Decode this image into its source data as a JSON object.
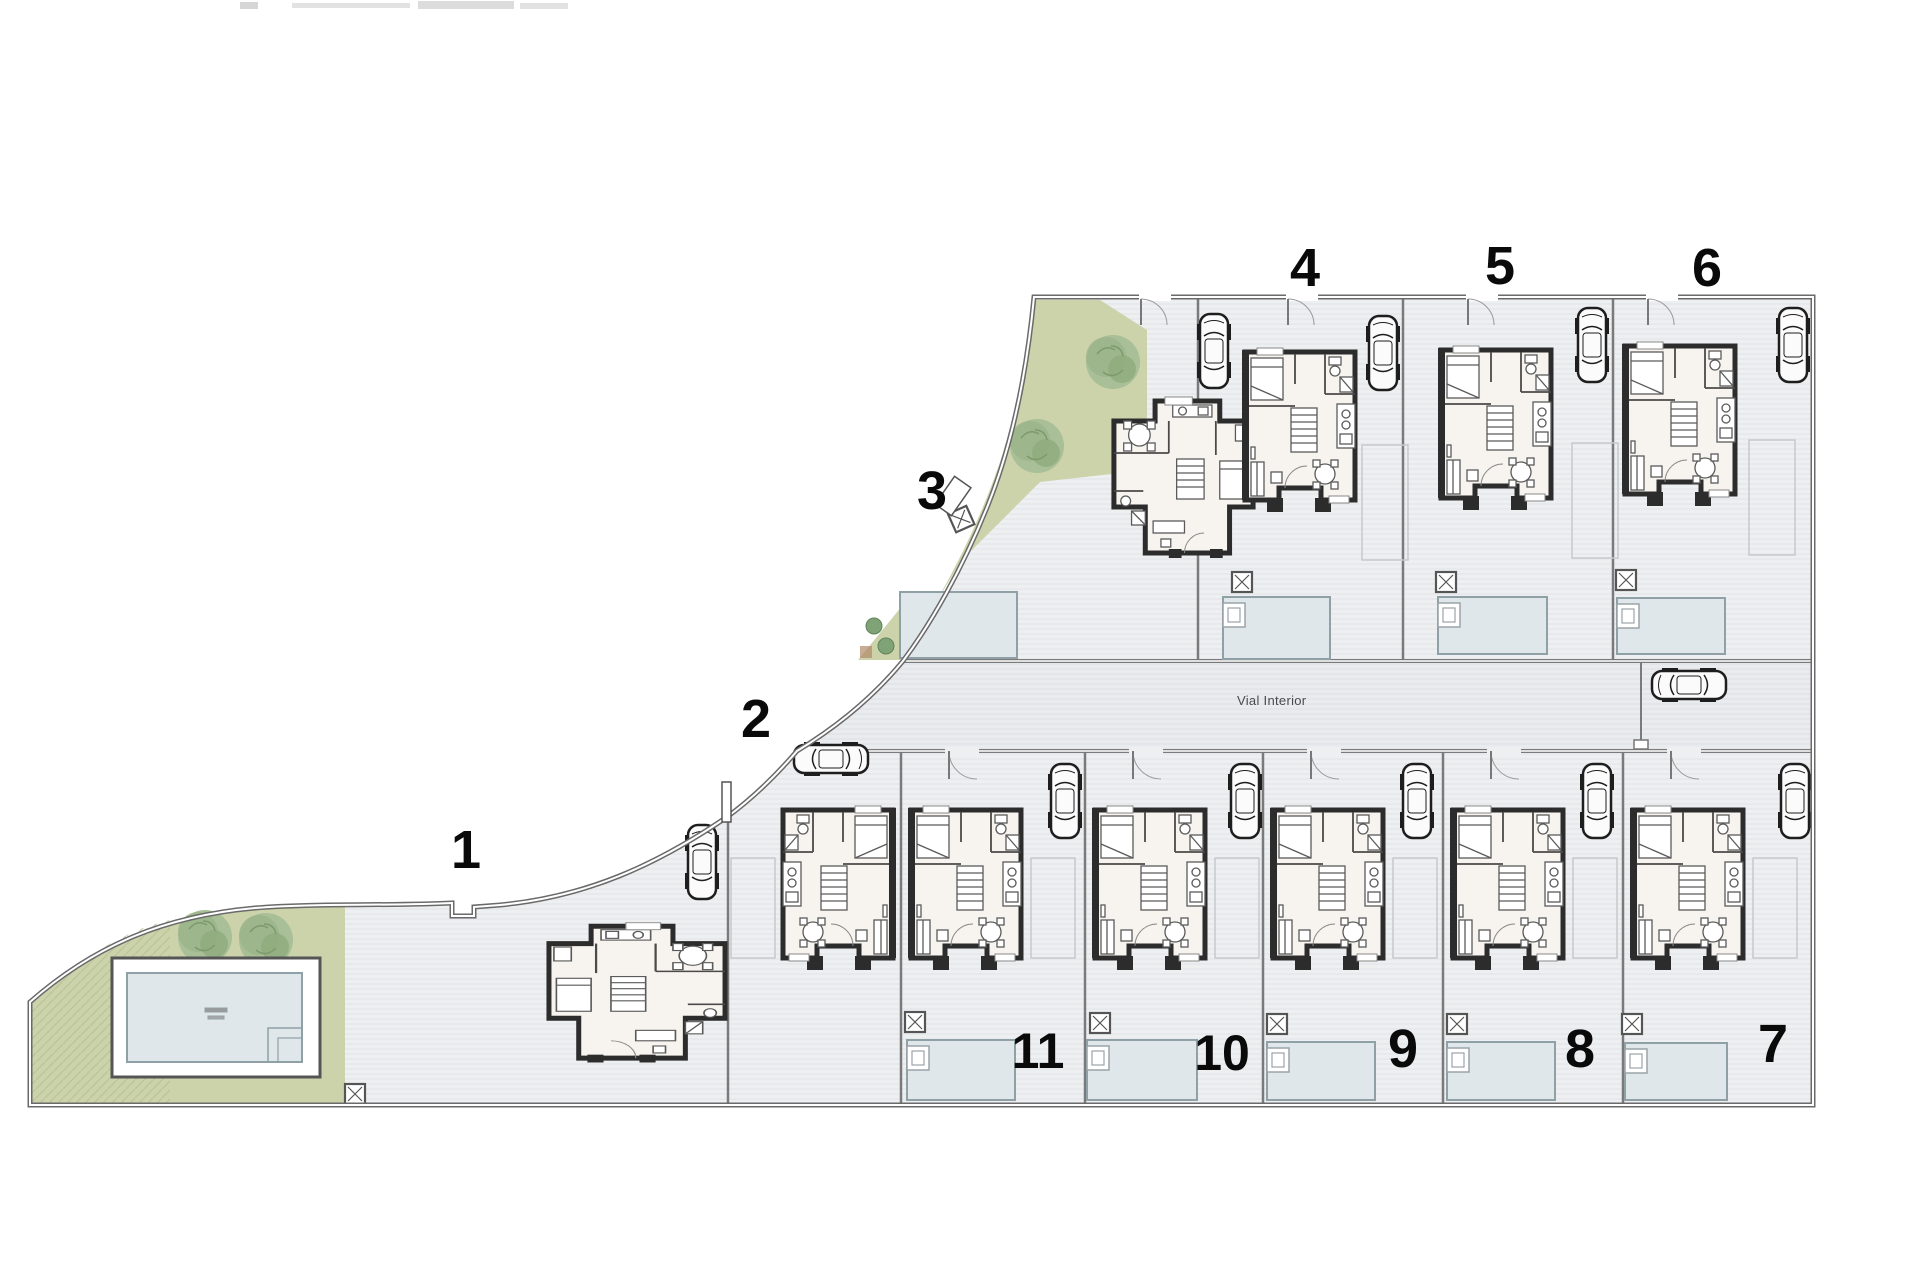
{
  "document": {
    "kind": "residential-site-plan"
  },
  "road": {
    "label": "Vial Interior"
  },
  "plots": [
    {
      "number": "1"
    },
    {
      "number": "2"
    },
    {
      "number": "3"
    },
    {
      "number": "4"
    },
    {
      "number": "5"
    },
    {
      "number": "6"
    },
    {
      "number": "7"
    },
    {
      "number": "8"
    },
    {
      "number": "9"
    },
    {
      "number": "10"
    },
    {
      "number": "11"
    }
  ],
  "colors": {
    "green_area": "#ccd3ab",
    "tree": "#9db88f",
    "pool_water": "#dfe7ea",
    "pool_border": "#8fa0a6",
    "paving": "#eeeff1",
    "road_paving": "#e9ebee",
    "boundary": "#6a6a6a",
    "house_wall": "#2c2c2c",
    "house_fill": "#f7f4ef",
    "label_text": "#0a0a0a",
    "road_label_text": "#4a4a4a"
  }
}
